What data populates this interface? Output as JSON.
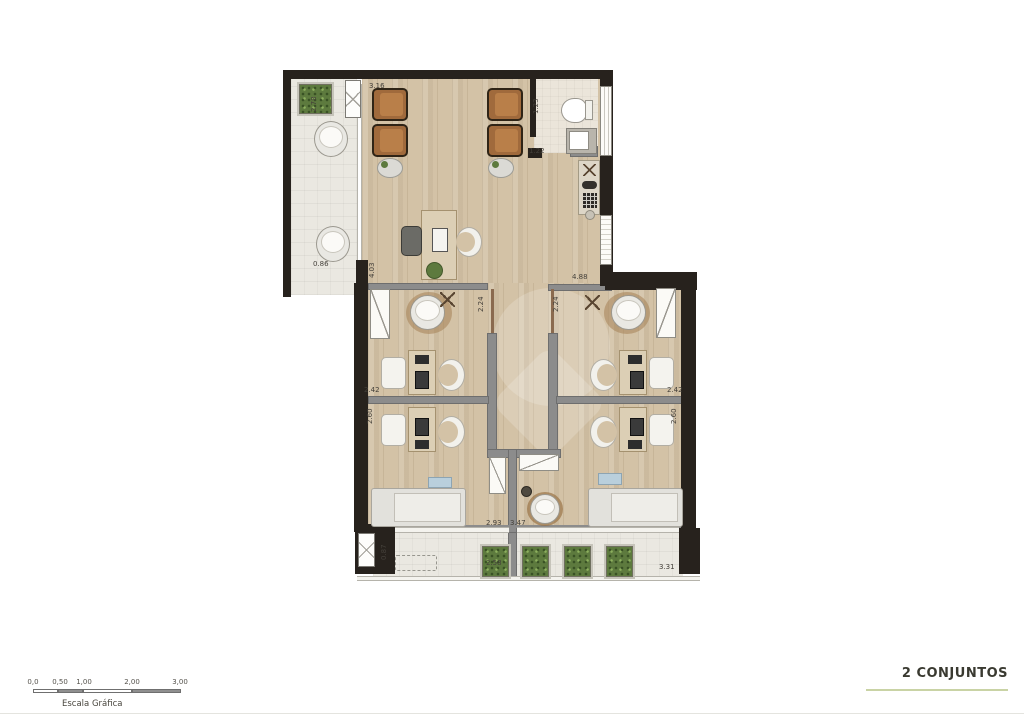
{
  "footer": {
    "title": "2 CONJUNTOS",
    "scale_label": "Escala Gráfica",
    "scale_ticks": [
      "0,0",
      "0,50",
      "1,00",
      "2,00",
      "3,00"
    ]
  },
  "dims": [
    {
      "v": "2.78"
    },
    {
      "v": "3.16"
    },
    {
      "v": "1.23"
    },
    {
      "v": "1.22"
    },
    {
      "v": "0.86"
    },
    {
      "v": "4.03"
    },
    {
      "v": "2.24"
    },
    {
      "v": "2.24"
    },
    {
      "v": "4.88"
    },
    {
      "v": "2.42"
    },
    {
      "v": "2.60"
    },
    {
      "v": "2.42"
    },
    {
      "v": "2.60"
    },
    {
      "v": "2.93"
    },
    {
      "v": "3.47"
    },
    {
      "v": "0.87"
    },
    {
      "v": "2.58"
    },
    {
      "v": "3.31"
    }
  ],
  "colors": {
    "wood_floor": "#d3c2a6",
    "balcony_tile": "#eae8e1",
    "exterior_wall": "#27221d",
    "partition_wall": "#8c8c8c",
    "armchair_brown": "#a06a3c",
    "planter_green": "#5d7a3e",
    "title_underline": "#c9d3a5"
  }
}
